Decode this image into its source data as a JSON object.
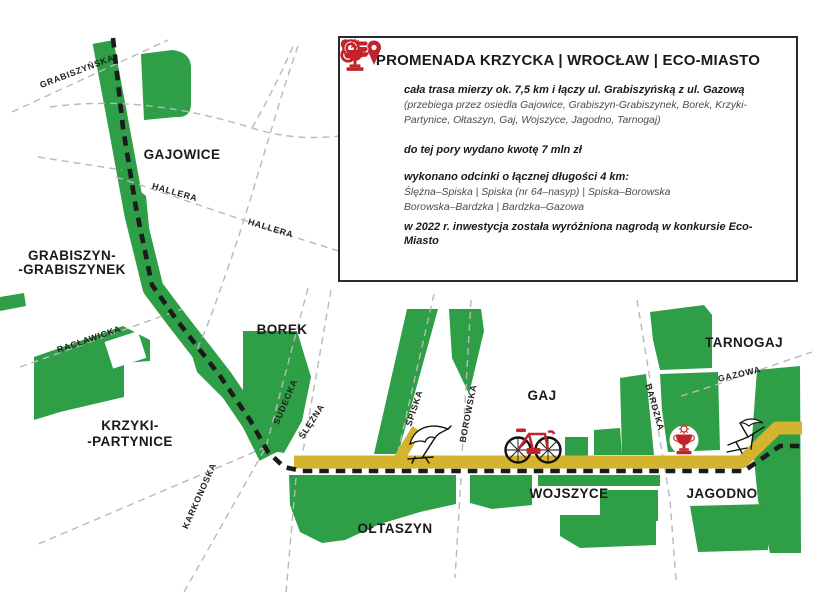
{
  "colors": {
    "park_green": "#2E9E47",
    "route_yellow": "#D4B42F",
    "accent_red": "#C2232A",
    "route_black": "#1B1B1B",
    "street_gray": "#B9B9B9"
  },
  "infobox": {
    "title": "PROMENADA KRZYCKA | WROCŁAW | ECO-MIASTO",
    "item1": {
      "text": "cała trasa mierzy ok. 7,5 km i łączy ul. Grabiszyńską z ul. Gazową",
      "note": "(przebiega przez osiedla Gajowice, Grabiszyn-Grabiszynek, Borek, Krzyki-Partynice, Ołtaszyn, Gaj, Wojszyce, Jagodno, Tarnogaj)"
    },
    "item2": {
      "text": "do tej pory wydano kwotę 7 mln zł"
    },
    "item3": {
      "text": "wykonano odcinki o łącznej długości 4 km:",
      "note1": "Ślężna–Spiska | Spiska (nr 64–nasyp) | Spiska–Borowska",
      "note2": "Borowska–Bardzka | Bardzka–Gazowa"
    },
    "item4": {
      "text": "w 2022 r. inwestycja została wyróżniona nagrodą w konkursie Eco-Miasto"
    }
  },
  "map": {
    "districts": {
      "gajowice": "GAJOWICE",
      "grabiszyn_line1": "GRABISZYN-",
      "grabiszyn_line2": "-GRABISZYNEK",
      "borek": "BOREK",
      "krzyki_line1": "KRZYKI-",
      "krzyki_line2": "-PARTYNICE",
      "oltaszyn": "OŁTASZYN",
      "wojszyce": "WOJSZYCE",
      "gaj": "GAJ",
      "jagodno": "JAGODNO",
      "tarnogaj": "TARNOGAJ"
    },
    "streets": {
      "grabiszynska": "GRABISZYŃSKA",
      "hallera1": "HALLERA",
      "hallera2": "HALLERA",
      "raclawicka": "RACŁAWICKA",
      "karkonoska": "KARKONOSKA",
      "sudecka": "SUDECKA",
      "slezna": "ŚLĘŻNA",
      "spiska": "SPISKA",
      "borowska": "BOROWSKA",
      "bardzka": "BARDZKA",
      "gazowa": "GAZOWA"
    }
  }
}
